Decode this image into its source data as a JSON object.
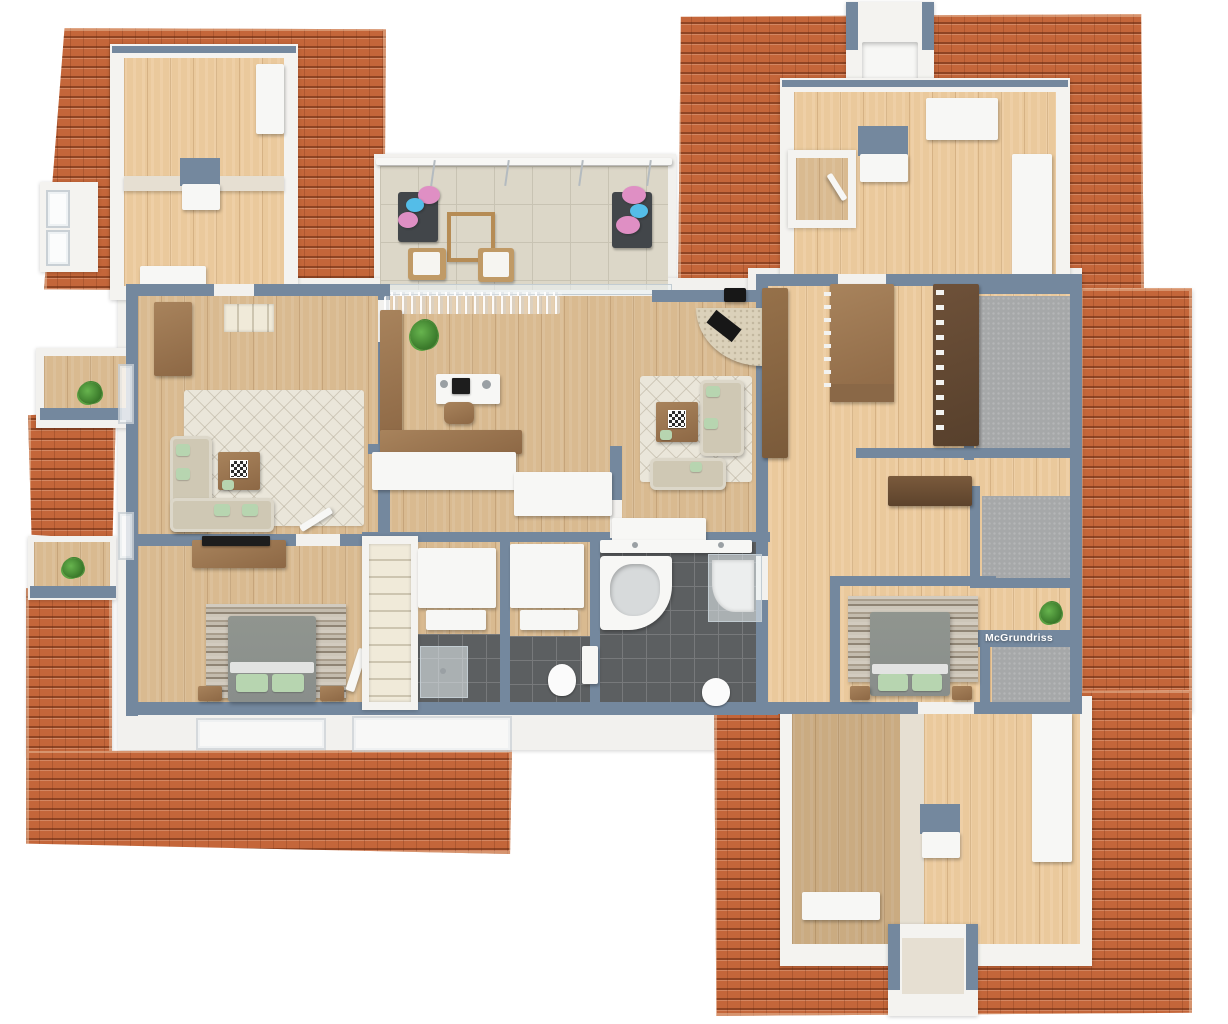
{
  "scene": {
    "description": "3D top-down rendering of an upper-storey floor plan with terracotta tiled roof surfaces"
  },
  "watermark": {
    "text": "McGrundriss"
  },
  "colors": {
    "roof": "#c4663a",
    "roof_dark": "#8d4322",
    "roof_light": "#e0966b",
    "wall": "#74889e",
    "wood": "#d9ba90",
    "terrace_tile": "#dcd7c8",
    "terrace_line": "#c8c3b3",
    "bath_tile": "#5c5f61",
    "bath_line": "#77797b",
    "carpet": "#a6a8a9",
    "rug": "#eae6da",
    "sofa": "#cfc8b4",
    "pillow": "#b7d5b0",
    "furniture_wood": "#a8835c",
    "furniture_wood_dark": "#6a4e35",
    "white_furniture": "#f7f7f5",
    "stone_light": "#d2cbbf",
    "stone_dark": "#8f8474",
    "bed": "#898e8b",
    "steps": "#f0ead9",
    "plant": "#3c7c2c",
    "flower_pink": "#df8fc4",
    "flower_blue": "#54bde8",
    "beige_wall": "#e6dfd2",
    "fire_black": "#171717"
  },
  "rooms": [
    "attic-room-top-left",
    "terrace",
    "home-office",
    "living-room-left",
    "living-room-center",
    "library",
    "walk-in-closet-top",
    "walk-in-closet-middle",
    "bedroom-left",
    "bedroom-right",
    "bathroom-main",
    "bathroom-small",
    "stairwell",
    "hallway",
    "attic-room-top-right",
    "attic-room-bottom-right"
  ],
  "furniture": [
    "corner-sofa",
    "coffee-table",
    "chess-board",
    "desk",
    "monitor",
    "desk-chair",
    "potted-plant",
    "kitchen-island",
    "bookshelf",
    "sideboard",
    "tv-lowboard",
    "double-bed",
    "nightstand",
    "stone-accent-wall",
    "corner-bathtub",
    "shower",
    "toilet",
    "vanity",
    "wardrobe",
    "lounge-chair",
    "flower-stand",
    "garden-table",
    "staircase",
    "fireplace"
  ]
}
